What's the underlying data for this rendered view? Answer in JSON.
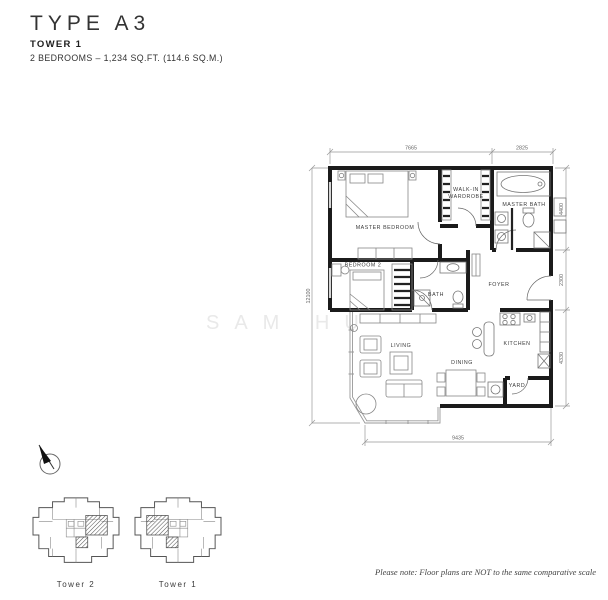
{
  "header": {
    "type_title": "TYPE A3",
    "tower": "TOWER 1",
    "specs": "2 BEDROOMS – 1,234 SQ.FT. (114.6 SQ.M.)"
  },
  "plan": {
    "rooms": {
      "master_bedroom": "MASTER BEDROOM",
      "walk_in_line1": "WALK-IN",
      "walk_in_line2": "WARDROBE",
      "master_bath": "MASTER BATH",
      "bedroom2": "BEDROOM 2",
      "bath": "BATH",
      "foyer": "FOYER",
      "living": "LIVING",
      "dining": "DINING",
      "kitchen": "KITCHEN",
      "yard": "YARD"
    },
    "dims": {
      "top_left": "7665",
      "top_right": "2825",
      "right_top": "4400",
      "right_mid": "2300",
      "right_bot": "4330",
      "left": "12100",
      "bottom": "9435"
    }
  },
  "key_plans": {
    "tower2": "Tower 2",
    "tower1": "Tower 1"
  },
  "watermark": "SAM HU",
  "footnote": "Please note: Floor plans are NOT to the same comparative scale",
  "colors": {
    "wall": "#1b1b1b",
    "watermark": "#e9e9e9"
  }
}
